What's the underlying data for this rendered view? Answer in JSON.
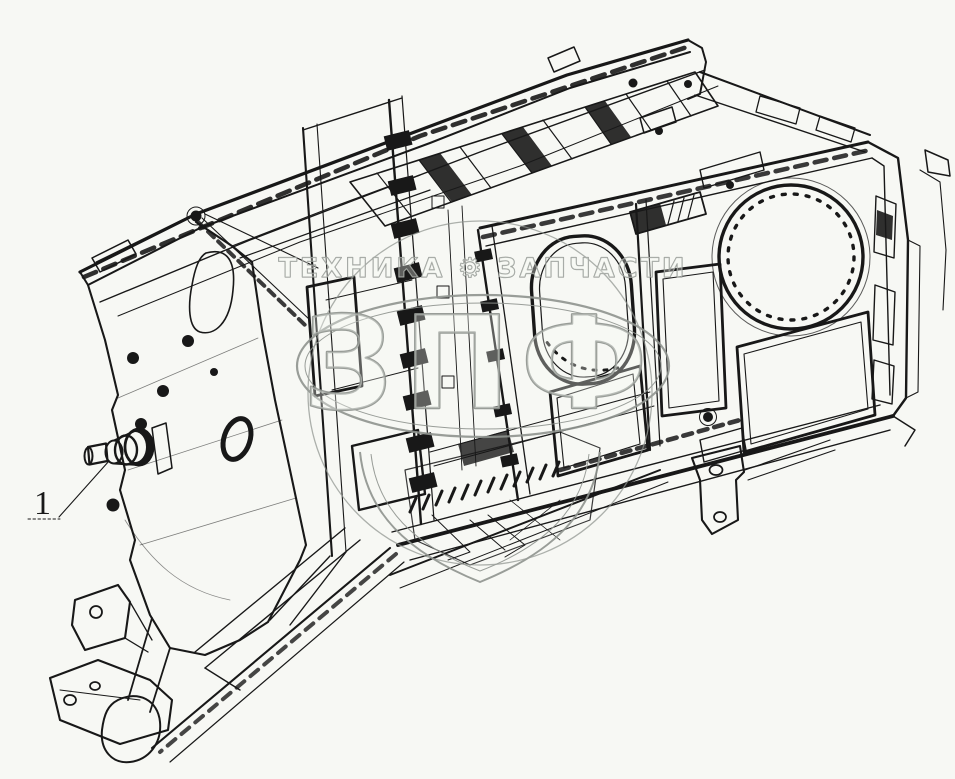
{
  "page": {
    "background_color": "#f7f8f4",
    "ink_color": "#181818"
  },
  "callout": {
    "label": "1"
  },
  "watermark": {
    "header_text": "ТЕХНИКА ⚙ ЗАПЧАСТИ",
    "logo_text": "ЗПФ",
    "color": "#8f948f"
  }
}
